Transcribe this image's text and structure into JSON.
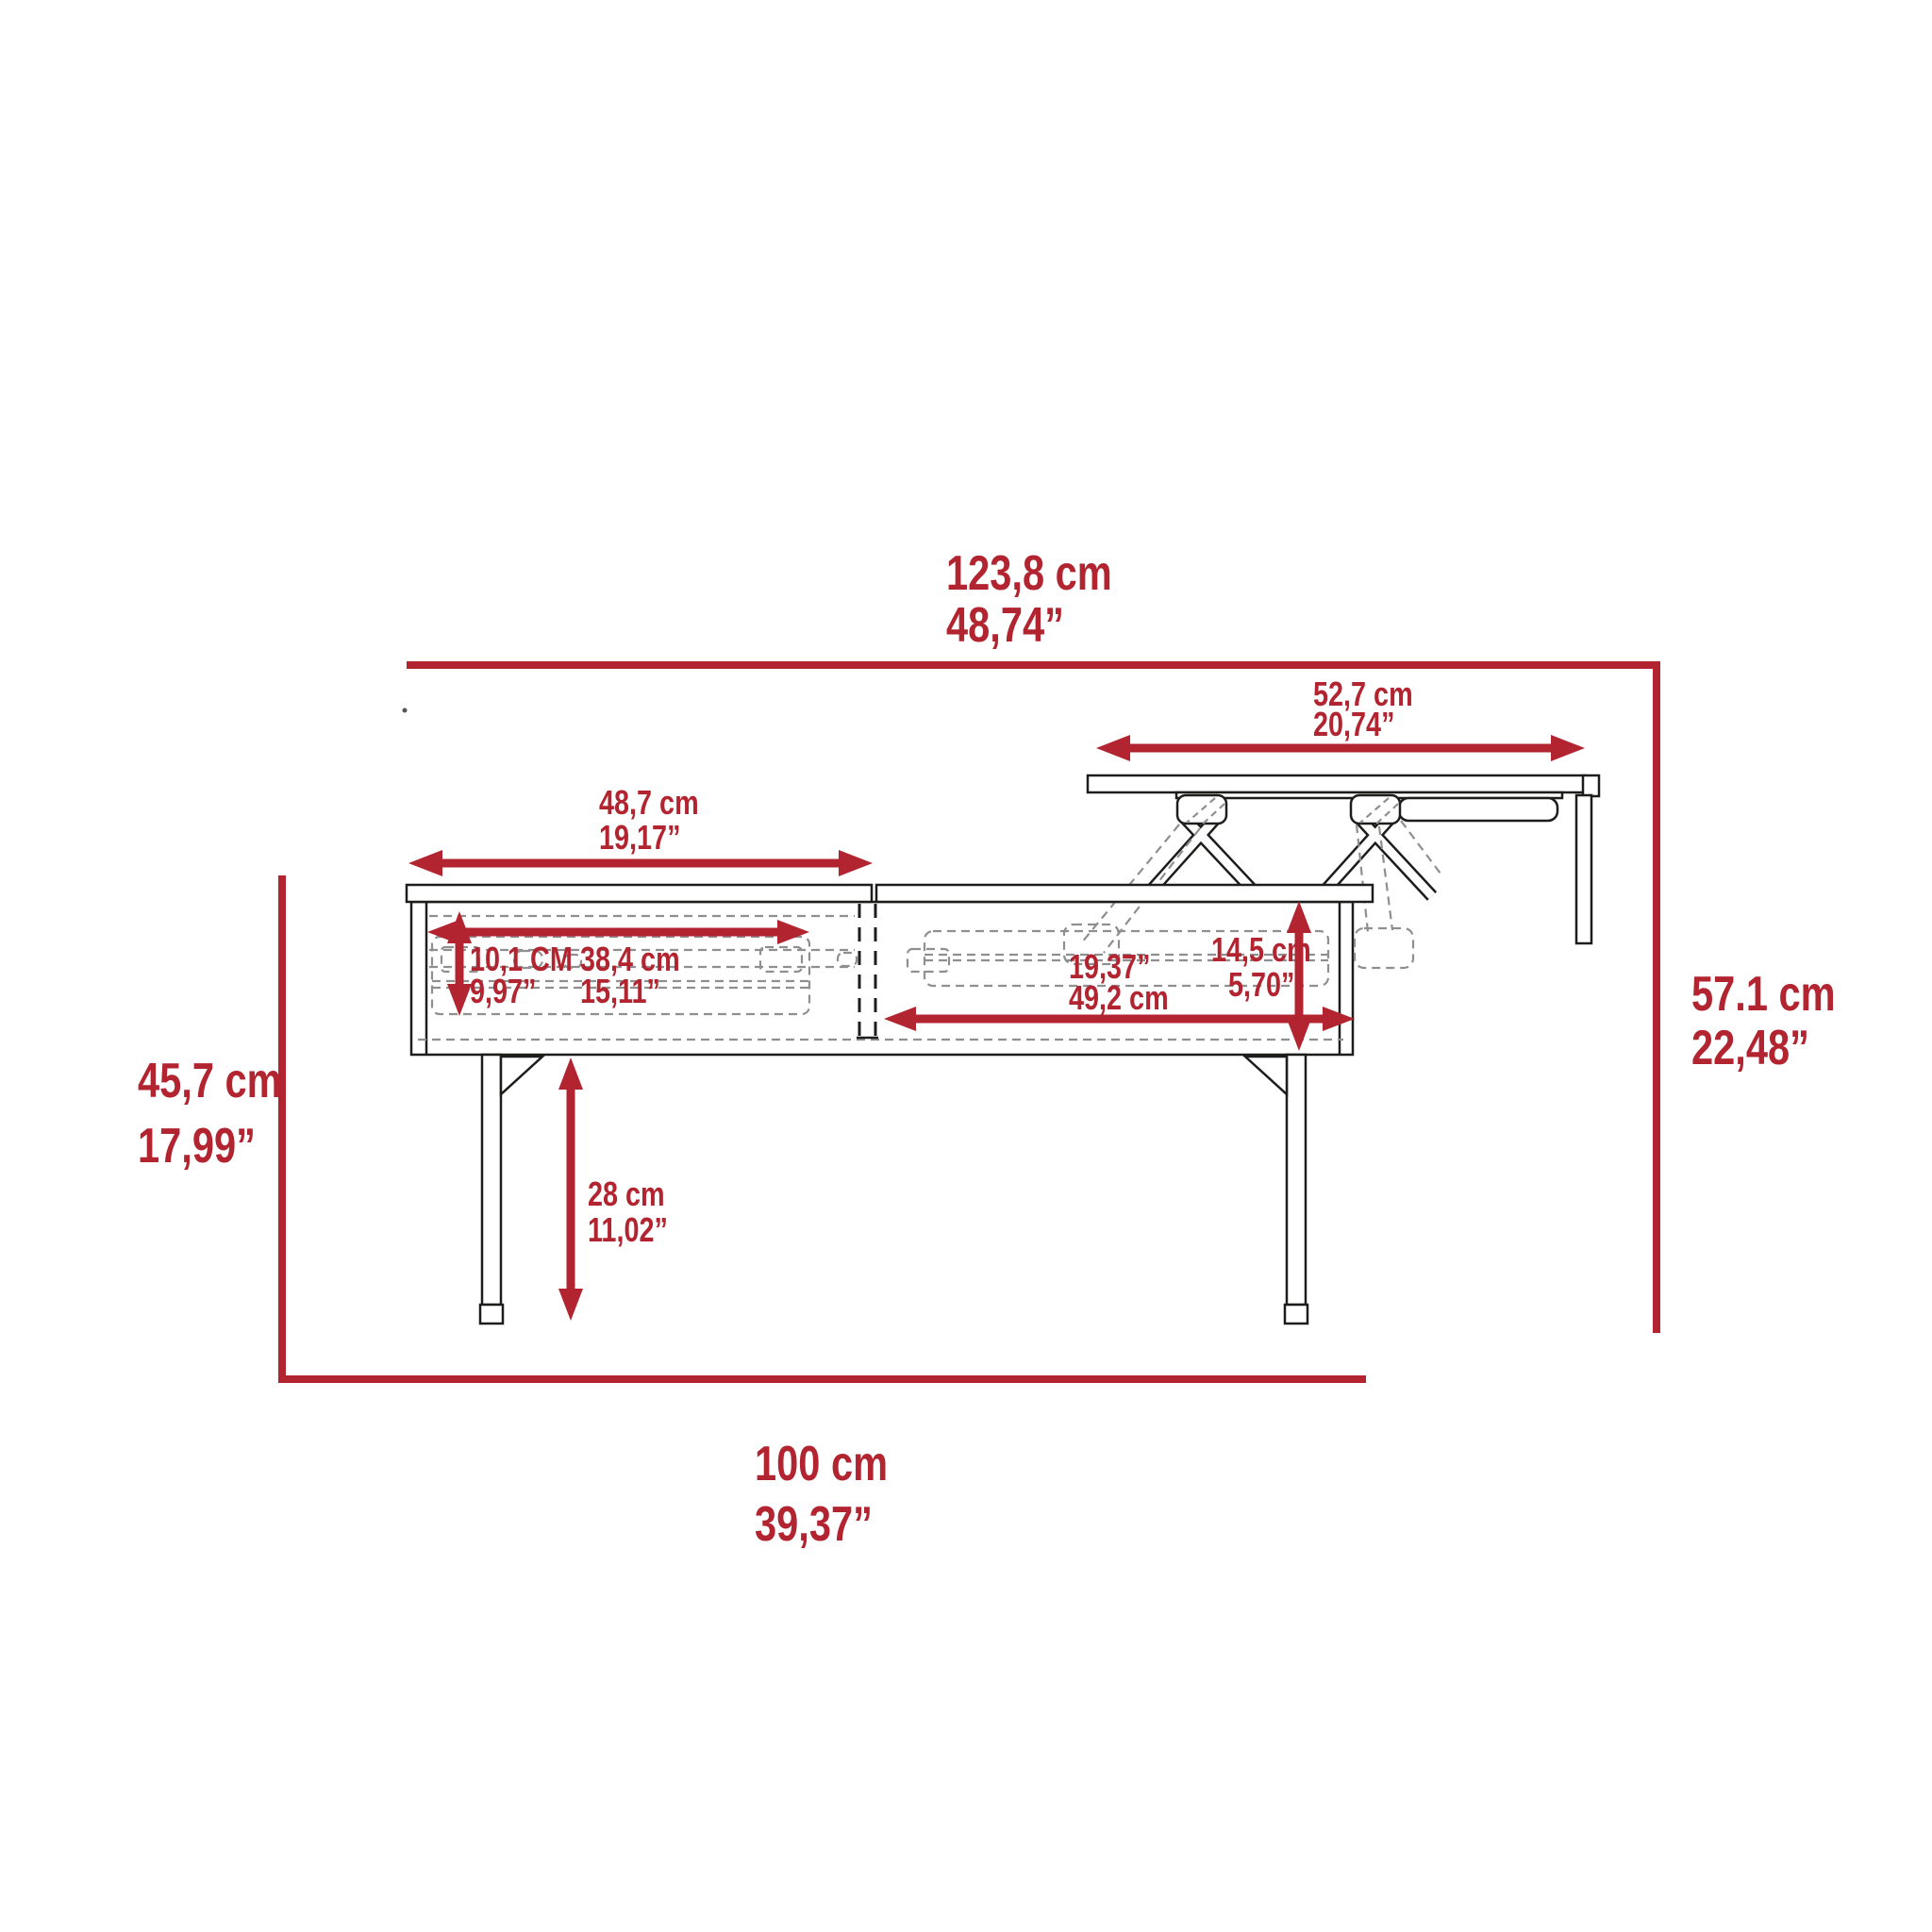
{
  "title": "Lift-top coffee table dimension diagram",
  "colors": {
    "accent": "#b22430",
    "line": "#1d1d1b",
    "dash": "#8f8f8f"
  },
  "dimensions": {
    "overall_width": {
      "cm": "123,8 cm",
      "in": "48,74”"
    },
    "lift_top_width": {
      "cm": "52,7 cm",
      "in": "20,74”"
    },
    "fixed_top_width": {
      "cm": "48,7 cm",
      "in": "19,17”"
    },
    "open_height": {
      "cm": "57.1 cm",
      "in": "22,48”"
    },
    "closed_height": {
      "cm": "45,7 cm",
      "in": "17,99”"
    },
    "drawer_height": {
      "cm": "10,1 CM",
      "in": "9,97”"
    },
    "drawer_width": {
      "cm": "38,4 cm",
      "in": "15,11”"
    },
    "right_compartment_width": {
      "in": "19,37”",
      "cm": "49,2 cm"
    },
    "lift_rise": {
      "cm": "14,5 cm",
      "in": "5,70”"
    },
    "leg_height": {
      "cm": "28 cm",
      "in": "11,02”"
    },
    "depth": {
      "cm": "100 cm",
      "in": "39,37”"
    }
  }
}
